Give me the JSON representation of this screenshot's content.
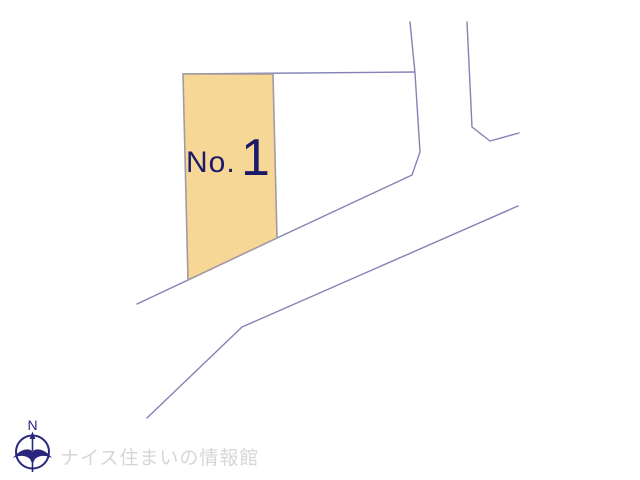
{
  "canvas": {
    "width": 640,
    "height": 480
  },
  "colors": {
    "boundary_line": "#8383b6",
    "parcel_fill": "#f7d795",
    "parcel_stroke": "#a39aa4",
    "label_navy": "#1c1a6b",
    "logo_navy": "#28277d",
    "watermark_gray": "#d6d6d6",
    "background": "#ffffff"
  },
  "parcel": {
    "label_prefix": "No.",
    "label_number": "1",
    "polygon": [
      [
        183,
        74
      ],
      [
        273,
        74
      ],
      [
        277,
        238
      ],
      [
        188,
        280
      ]
    ]
  },
  "boundary_lines": [
    {
      "name": "top-boundary-line",
      "points": [
        [
          183,
          74
        ],
        [
          414,
          72
        ]
      ]
    },
    {
      "name": "west-road-edge",
      "points": [
        [
          410,
          22
        ],
        [
          415,
          73
        ],
        [
          420,
          152
        ],
        [
          412,
          175
        ],
        [
          277,
          238
        ],
        [
          188,
          280
        ],
        [
          137,
          304
        ]
      ]
    },
    {
      "name": "east-boundary-line",
      "points": [
        [
          467,
          22
        ],
        [
          472,
          127
        ],
        [
          490,
          141
        ],
        [
          519,
          133
        ]
      ]
    },
    {
      "name": "south-road-edge",
      "points": [
        [
          147,
          418
        ],
        [
          242,
          327
        ],
        [
          518,
          206
        ]
      ]
    }
  ],
  "compass": {
    "label": "N"
  },
  "footer": {
    "brand_text": "ナイス住まいの情報館"
  }
}
